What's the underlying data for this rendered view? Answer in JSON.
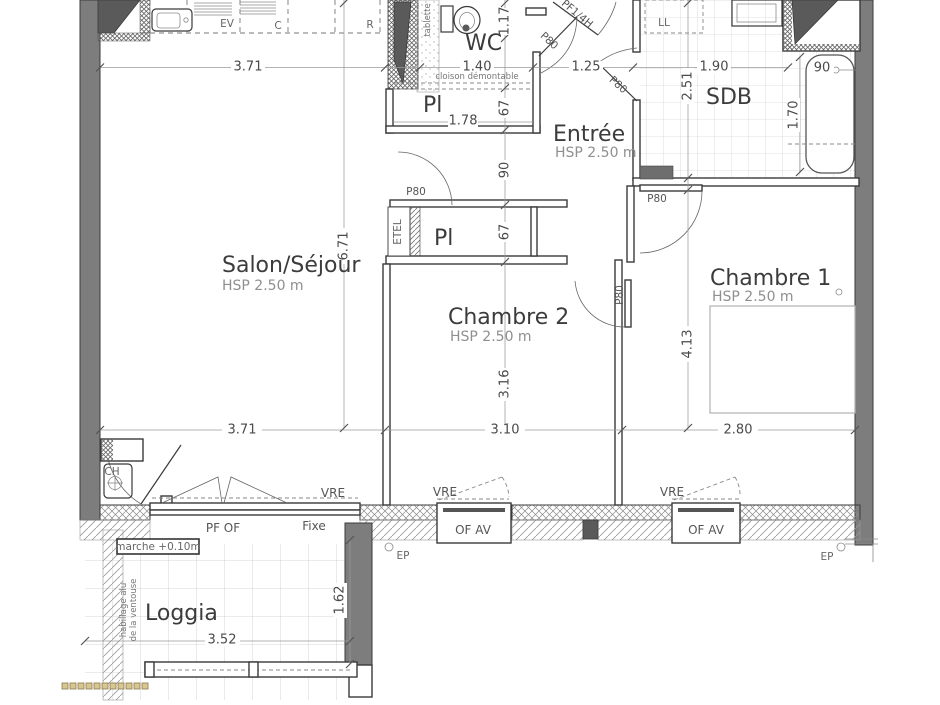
{
  "rooms": {
    "salon": {
      "name": "Salon/Séjour",
      "hsp": "HSP 2.50 m"
    },
    "entree": {
      "name": "Entrée",
      "hsp": "HSP 2.50 m"
    },
    "chambre1": {
      "name": "Chambre 1",
      "hsp": "HSP 2.50 m"
    },
    "chambre2": {
      "name": "Chambre 2",
      "hsp": "HSP 2.50 m"
    },
    "wc": {
      "name": "WC"
    },
    "sdb": {
      "name": "SDB"
    },
    "pl_upper": {
      "name": "Pl"
    },
    "pl_lower": {
      "name": "Pl"
    },
    "etel": {
      "name": "ETEL"
    },
    "loggia": {
      "name": "Loggia"
    }
  },
  "fixtures": {
    "ev": "EV",
    "c": "C",
    "r": "R",
    "ll": "LL",
    "ch": "CH",
    "tablette": "tablette"
  },
  "doors": {
    "entrance": "PF1/4H",
    "interior": "P80"
  },
  "windows": {
    "pf_of": "PF OF",
    "fixe": "Fixe",
    "of_av": "OF AV",
    "vre": "VRE",
    "ep": "EP"
  },
  "notes": {
    "cloison": "cloison démontable",
    "marche": "marche +0.10m",
    "ventouse_line1": "habillage alu",
    "ventouse_line2": "de la ventouse"
  },
  "dims": {
    "d371_top": "3.71",
    "d140": "1.40",
    "d117": "1.17",
    "d125": "1.25",
    "d190": "1.90",
    "d251": "2.51",
    "d90_bath": "90",
    "d170": "1.70",
    "d90_hall": "90",
    "d67_a": "67",
    "d178": "1.78",
    "d67_b": "67",
    "d671": "6.71",
    "d316": "3.16",
    "d413": "4.13",
    "d371_bottom": "3.71",
    "d310": "3.10",
    "d280": "2.80",
    "d352": "3.52",
    "d162": "1.62"
  }
}
